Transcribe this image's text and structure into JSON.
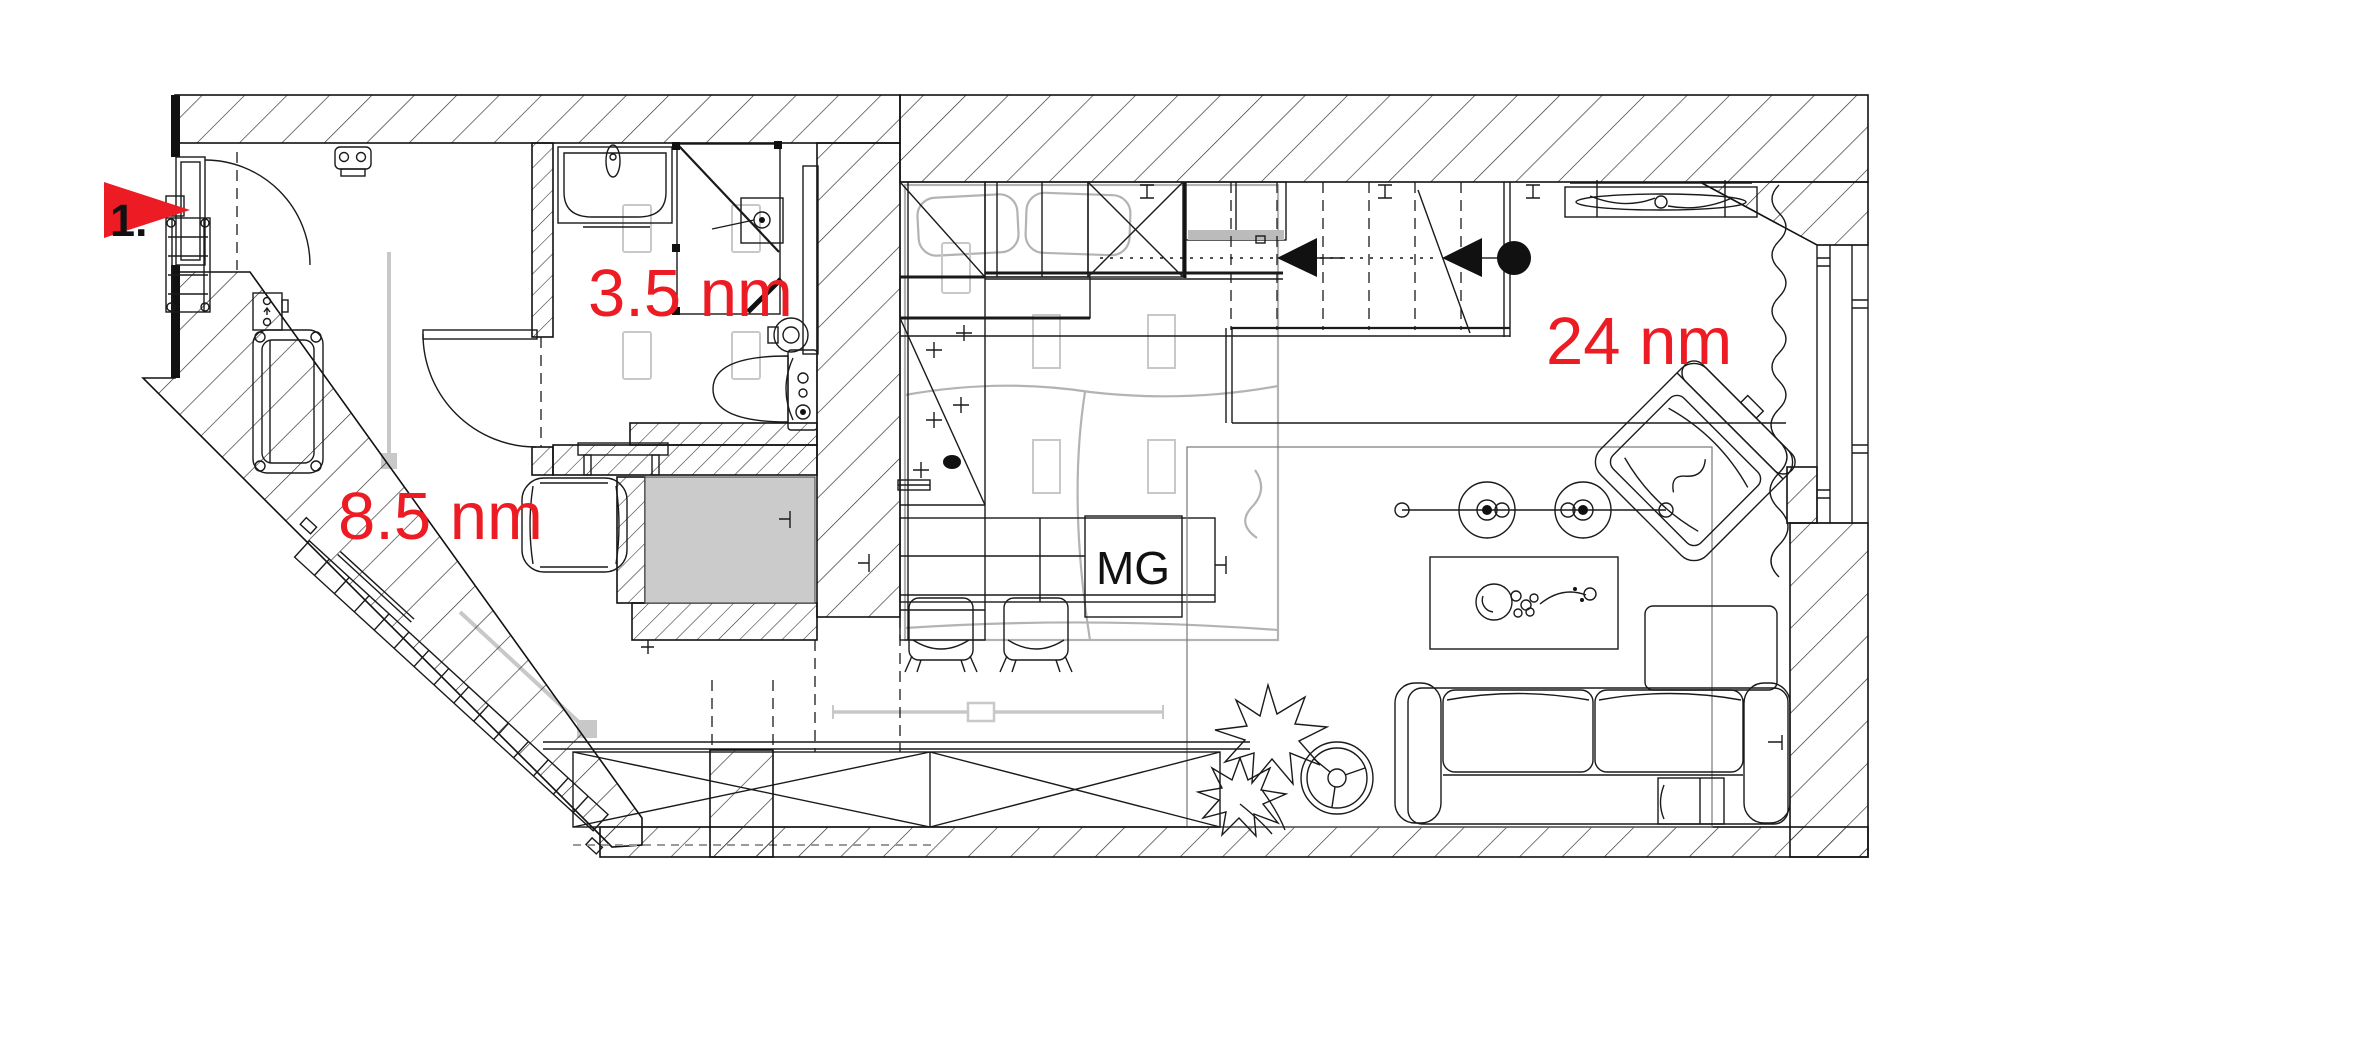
{
  "plan": {
    "type": "apartment floor plan",
    "marker": {
      "number": "1."
    },
    "rooms": {
      "hallway": {
        "area_label": "8.5 nm"
      },
      "bathroom": {
        "area_label": "3.5 nm"
      },
      "living": {
        "area_label": "24 nm"
      }
    },
    "appliances": {
      "washing_machine": {
        "label": "MG"
      }
    }
  },
  "colors": {
    "label_red": "#ed1c24",
    "ink": "#1a1a1a",
    "ghost_gray": "#c8c8c8",
    "bed_gray": "#b3b3b3",
    "appliance_fill": "#cbcbcb",
    "shelf_gray": "#bbbbbb",
    "background": "#ffffff"
  }
}
